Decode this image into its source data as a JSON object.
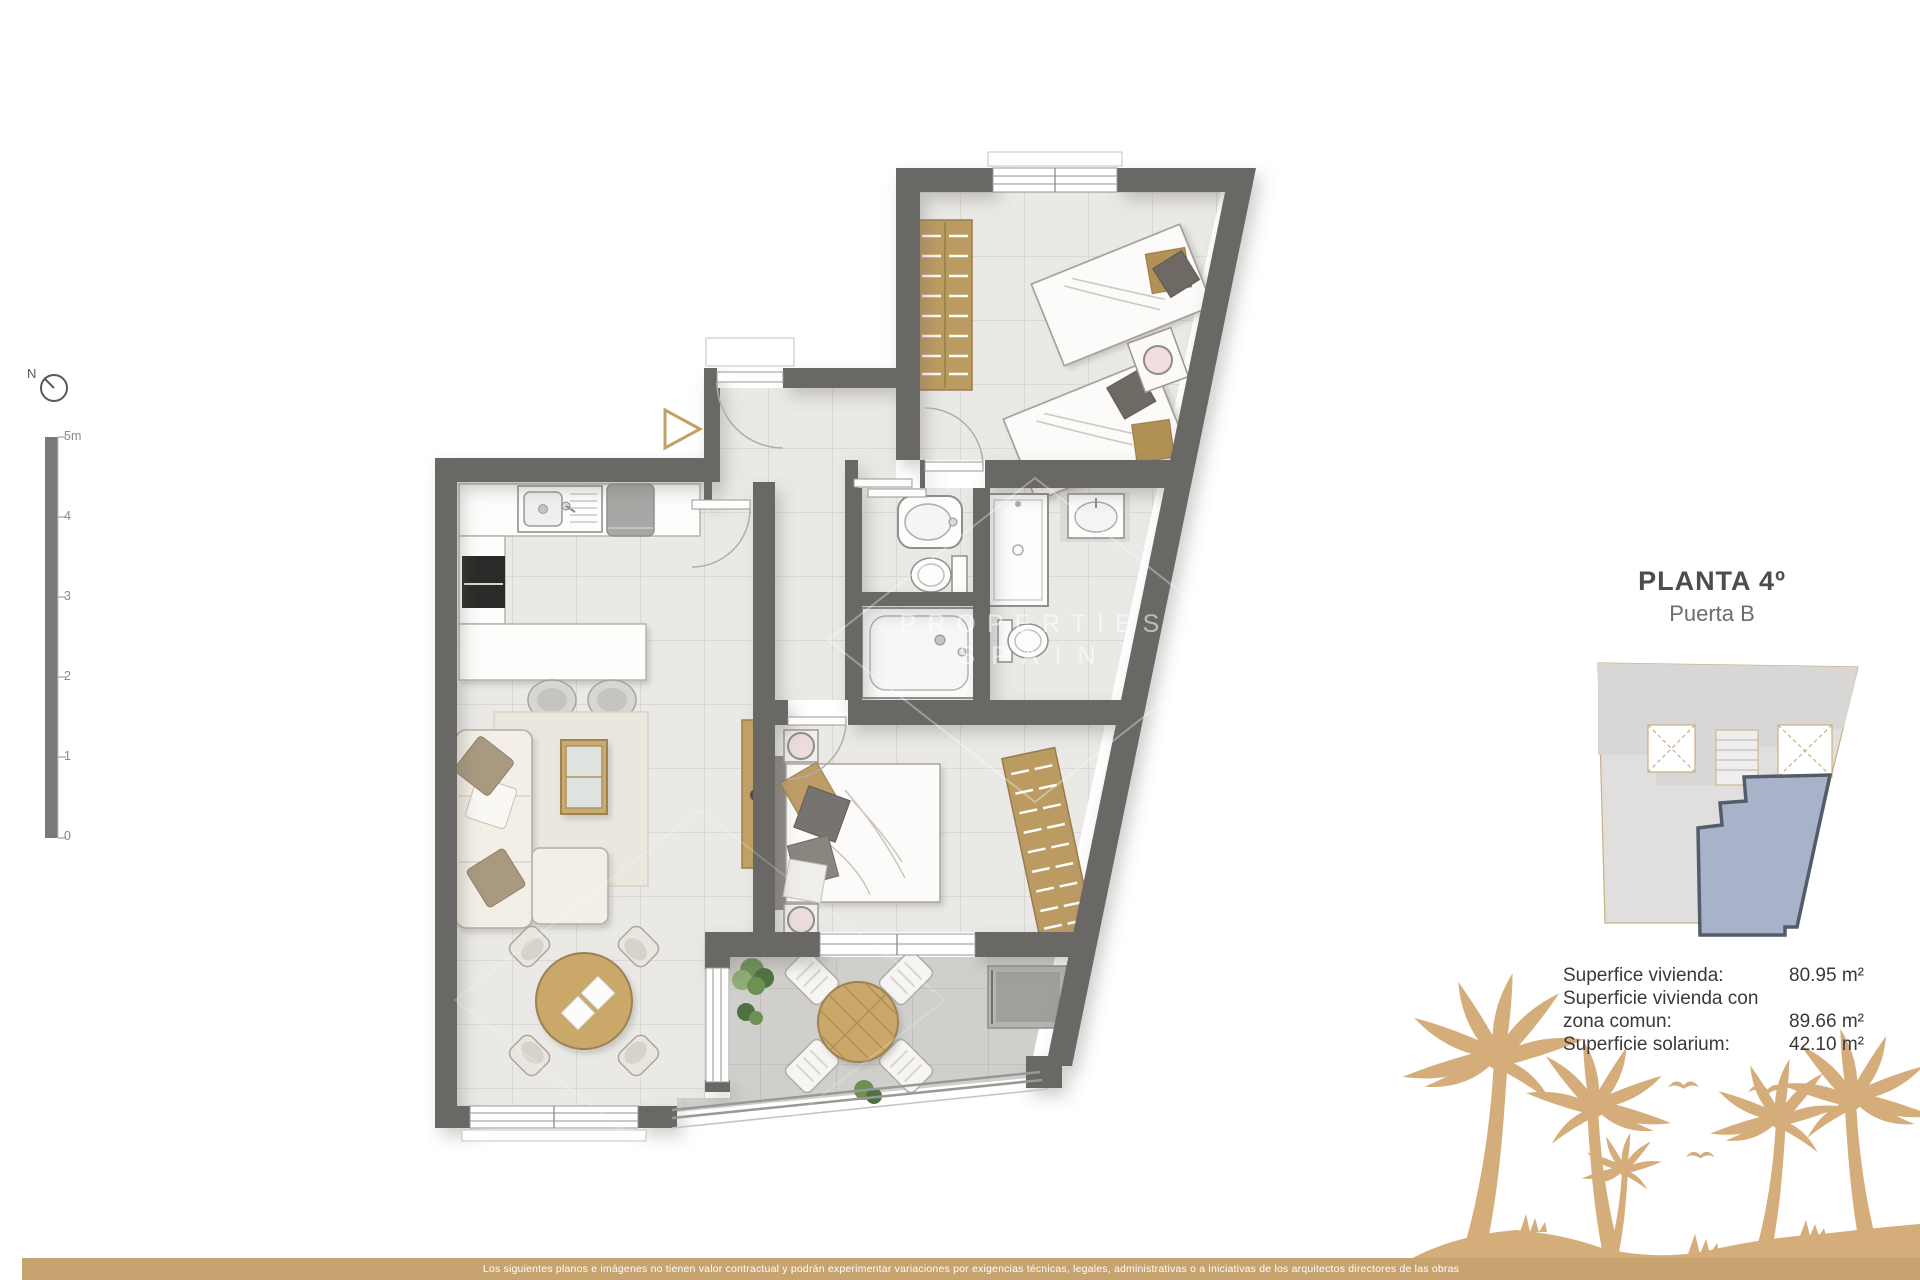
{
  "title": {
    "floor": "PLANTA 4º",
    "door": "Puerta B"
  },
  "areas": {
    "rows": [
      {
        "label": "Superfice vivienda:",
        "value": "80.95 m²"
      },
      {
        "label": "Superficie vivienda con",
        "value": ""
      },
      {
        "label": "zona comun:",
        "value": "89.66 m²"
      },
      {
        "label": "Superficie solarium:",
        "value": "42.10 m²"
      }
    ]
  },
  "compass": {
    "label": "N"
  },
  "scale_bar": {
    "labels": [
      "5m",
      "4",
      "3",
      "2",
      "1",
      "0"
    ]
  },
  "watermark": {
    "line1": "PROPERTIES",
    "line2": "SPAIN"
  },
  "disclaimer": "Los siguientes planos e imágenes no tienen valor contractual y podrán experimentar variaciones por exigencias técnicas, legales, administrativas o a iniciativas de los arquitectos directores de las obras",
  "colors": {
    "wall": "#6b6865",
    "accent_tan": "#cfa873",
    "bar_tan": "#c7a36f",
    "palm_tan": "#d4ad7a",
    "unit_highlight": "#a8b2c8",
    "tile_light": "#eae9e6",
    "terrace_tile": "#d0cfcc"
  }
}
